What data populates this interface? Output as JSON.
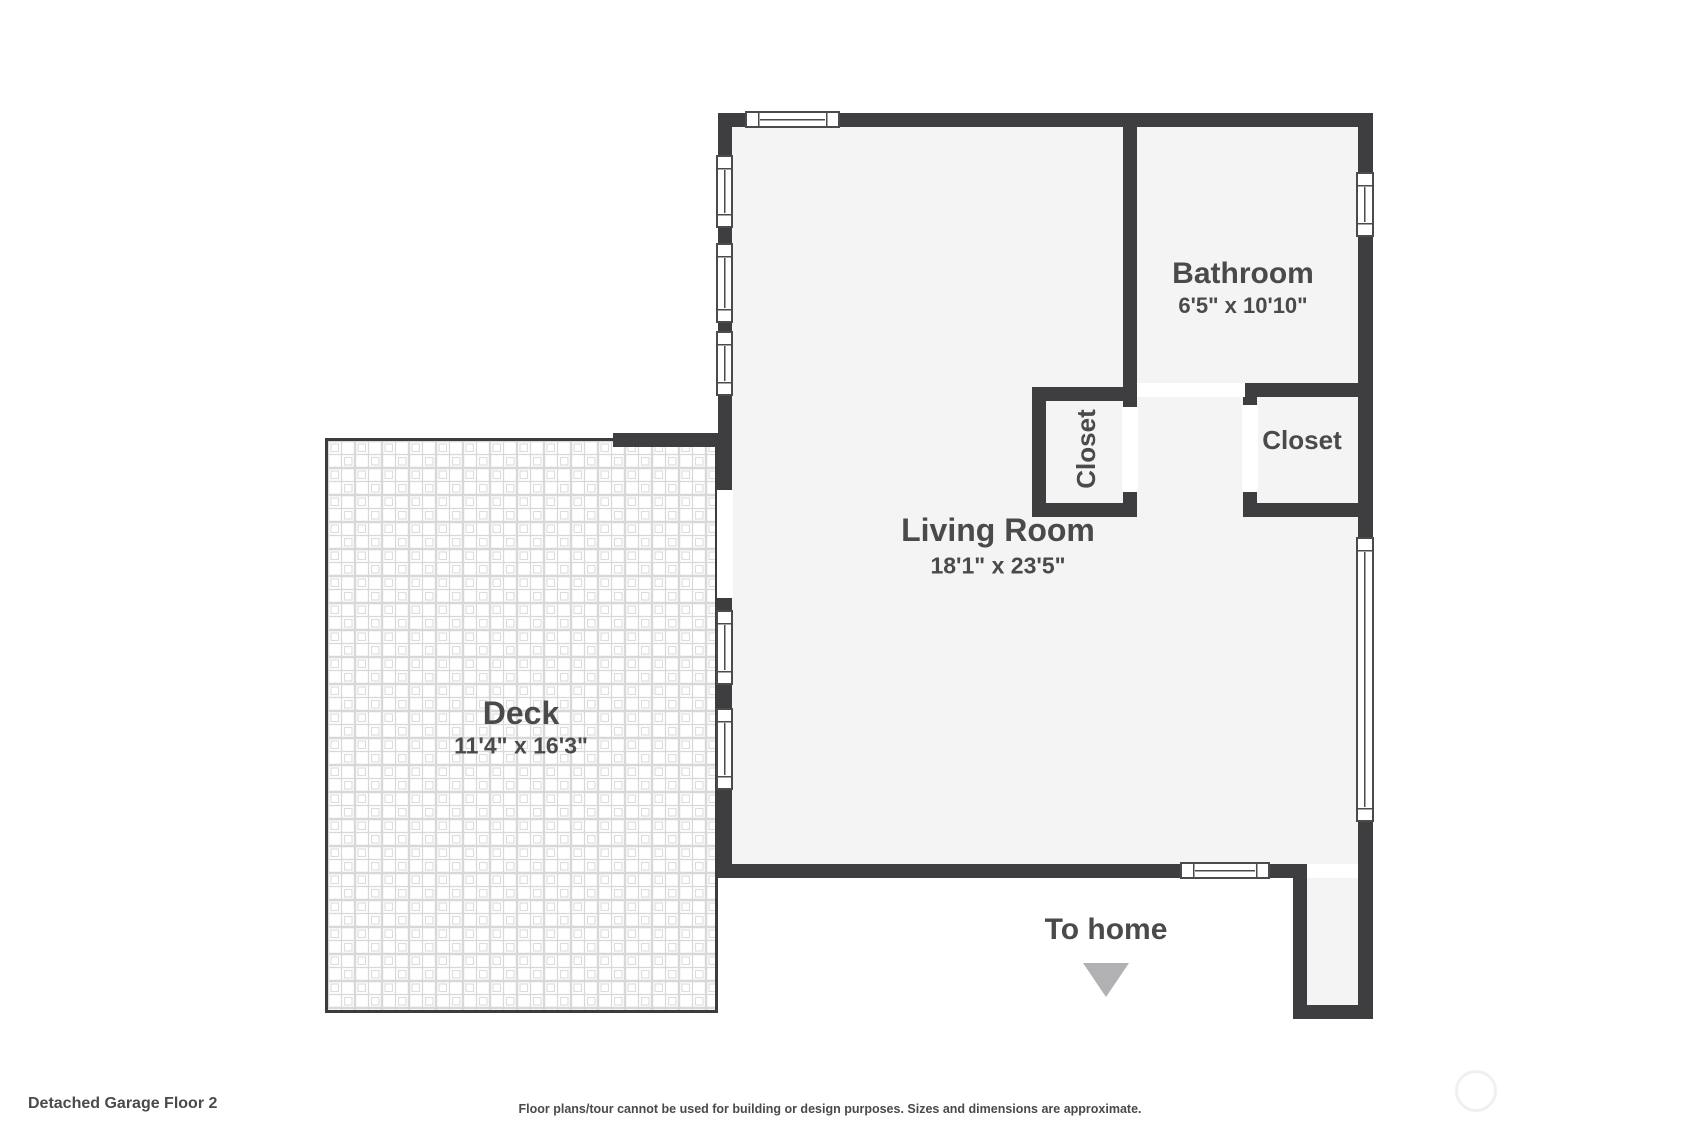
{
  "footer": {
    "title": "Detached Garage Floor 2",
    "disclaimer": "Floor plans/tour cannot be used for building or design purposes. Sizes and dimensions are approximate."
  },
  "rooms": {
    "living_room": {
      "name": "Living Room",
      "dimensions": "18'1\" x 23'5\""
    },
    "bathroom": {
      "name": "Bathroom",
      "dimensions": "6'5\" x 10'10\""
    },
    "closet_middle": {
      "label": "Closet"
    },
    "closet_right": {
      "label": "Closet"
    },
    "deck": {
      "name": "Deck",
      "dimensions": "11'4\" x 16'3\""
    }
  },
  "annotations": {
    "to_home": "To home",
    "arrow_icon": "triangle-down"
  },
  "colors": {
    "wall": "#3e3e40",
    "floor": "#f4f4f5",
    "text": "#4a4a4c",
    "arrow": "#b1b1b3",
    "tile_line": "#d8d8d8"
  }
}
